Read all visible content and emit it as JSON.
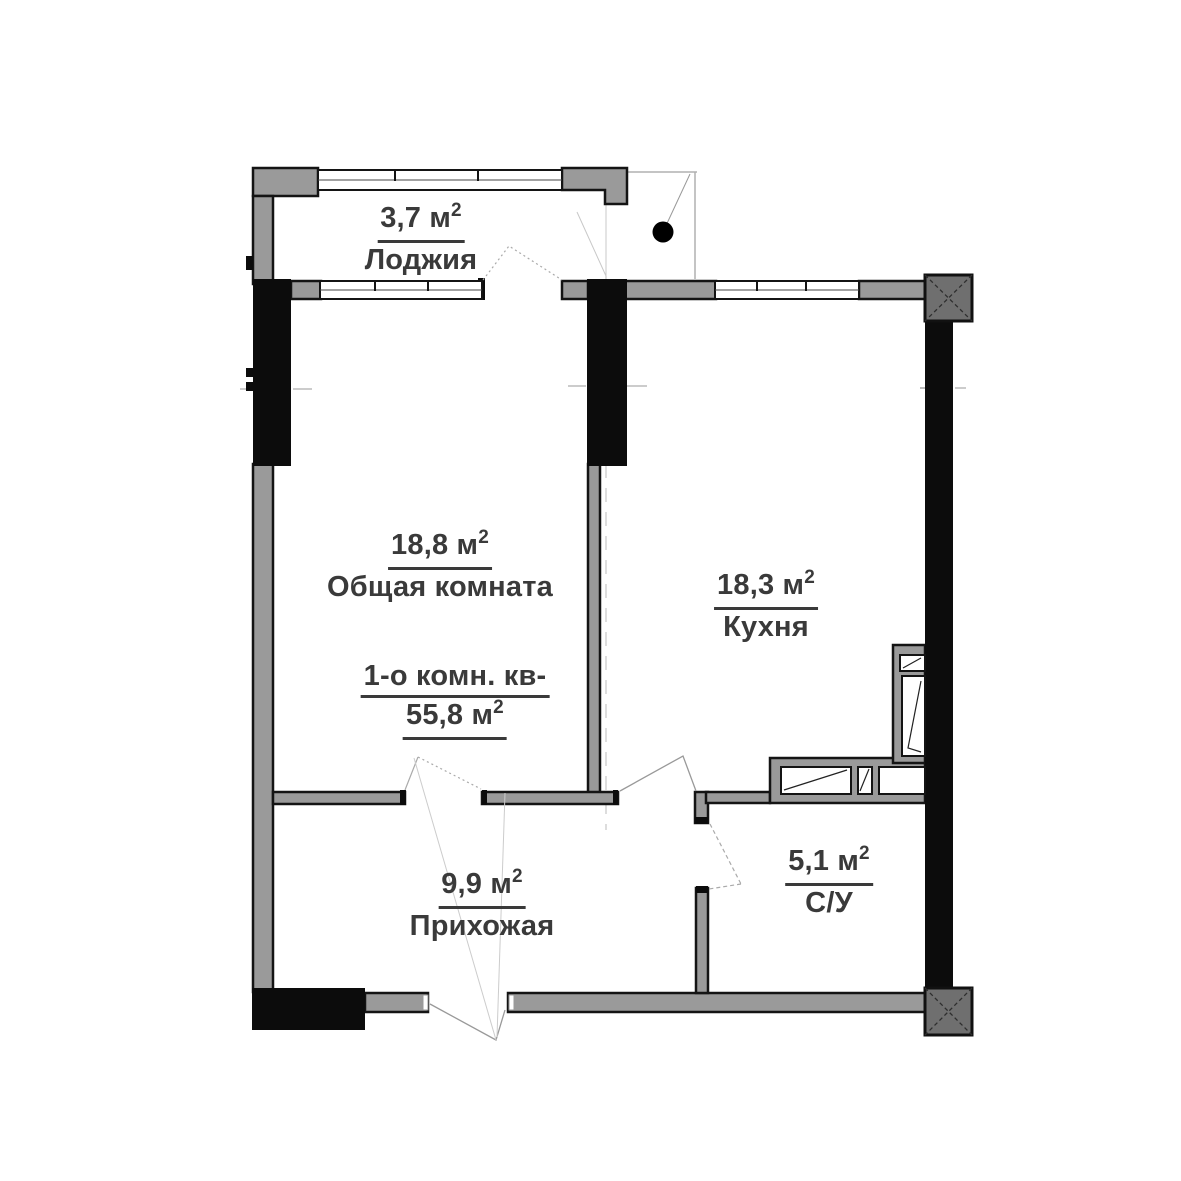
{
  "apartment": {
    "line1": "1-о комн. кв-",
    "area": "55,8 м",
    "sup": "2"
  },
  "rooms": [
    {
      "id": "loggia",
      "area": "3,7 м",
      "sup": "2",
      "name": "Лоджия"
    },
    {
      "id": "living",
      "area": "18,8 м",
      "sup": "2",
      "name": "Общая комната"
    },
    {
      "id": "kitchen",
      "area": "18,3 м",
      "sup": "2",
      "name": "Кухня"
    },
    {
      "id": "hallway",
      "area": "9,9 м",
      "sup": "2",
      "name": "Прихожая"
    },
    {
      "id": "bathroom",
      "area": "5,1 м",
      "sup": "2",
      "name": "С/У"
    }
  ],
  "colors": {
    "wall_gray": "#9a9a9a",
    "wall_black": "#0c0c0c",
    "hatched_column": "#6f6f6f",
    "thin_line": "#b0b0b0",
    "text": "#3a3a3a",
    "background": "#ffffff"
  }
}
